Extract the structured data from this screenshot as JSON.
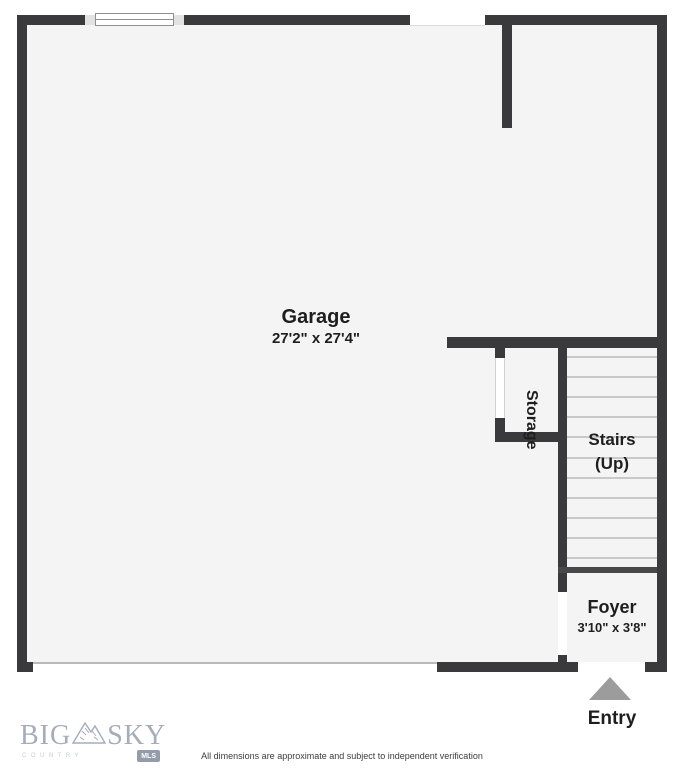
{
  "colors": {
    "wall": "#3a3a3c",
    "floor": "#f4f4f4",
    "step_line": "#c9c9c9",
    "entry_arrow": "#9c9c9c",
    "logo": "#a5adbb"
  },
  "plan": {
    "garage": {
      "name": "Garage",
      "dims": "27'2\" x 27'4\""
    },
    "storage": {
      "name": "Storage"
    },
    "stairs": {
      "line1": "Stairs",
      "line2": "(Up)",
      "step_count": 11
    },
    "foyer": {
      "name": "Foyer",
      "dims": "3'10\" x 3'8\""
    },
    "entry": {
      "label": "Entry"
    }
  },
  "footer": {
    "logo": {
      "left": "BIG",
      "right": "SKY",
      "tagline": "COUNTRY",
      "badge": "MLS"
    },
    "disclaimer": "All dimensions are approximate and subject to independent verification"
  }
}
